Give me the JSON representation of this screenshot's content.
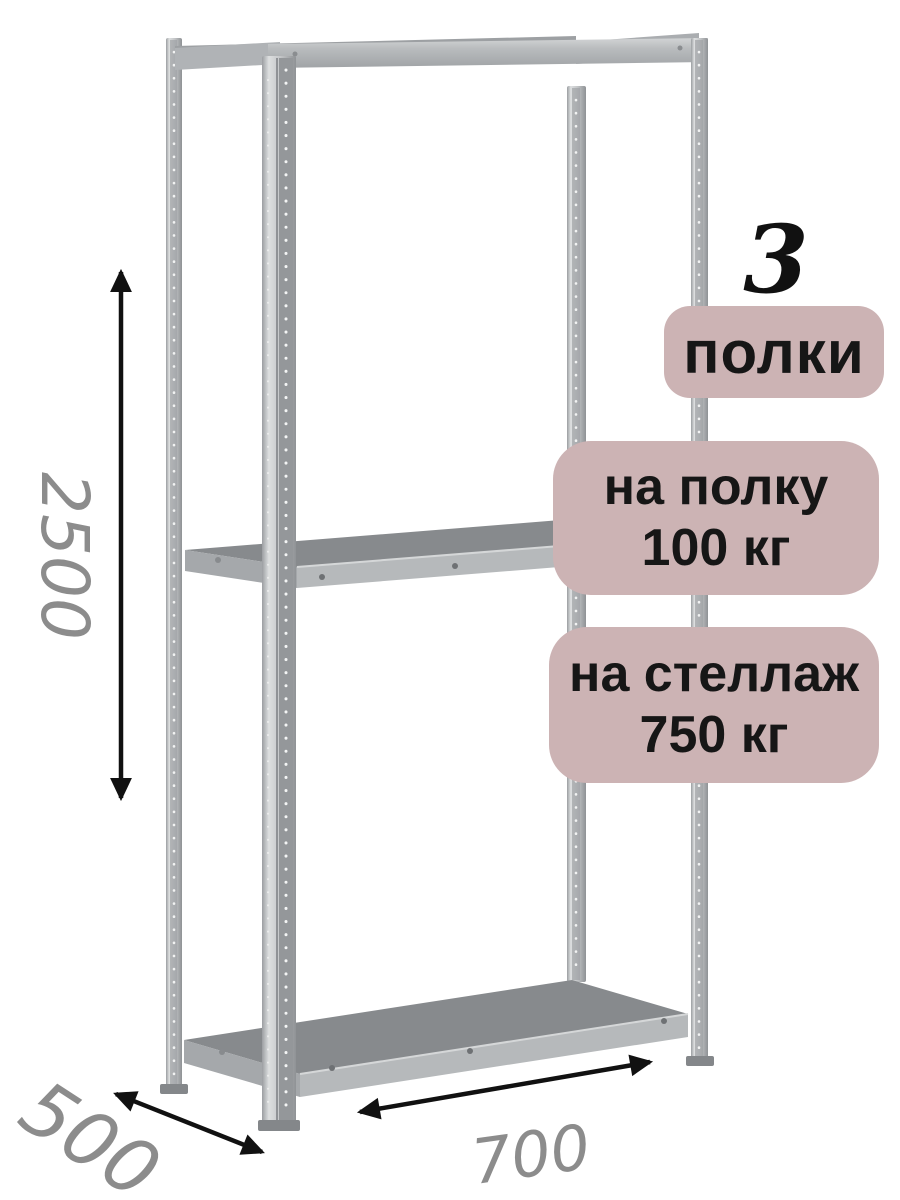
{
  "badges": {
    "shelf_count": {
      "number": "3",
      "label": "полки"
    },
    "shelf_load": {
      "line1": "на полку",
      "line2": "100 кг"
    },
    "rack_load": {
      "line1": "на стеллаж",
      "line2": "750 кг"
    }
  },
  "dimensions": {
    "height_mm": "2500",
    "depth_mm": "500",
    "width_mm": "700"
  },
  "icons": {
    "height_arrow": "double-headed-vertical-arrow",
    "depth_arrow": "double-headed-diagonal-arrow",
    "width_arrow": "double-headed-diagonal-arrow"
  },
  "colors": {
    "badge_bg": "#ccb3b4",
    "badge_text": "#161616",
    "count_number": "#111111",
    "dim_text": "#8c8c8c",
    "arrow": "#111111"
  }
}
